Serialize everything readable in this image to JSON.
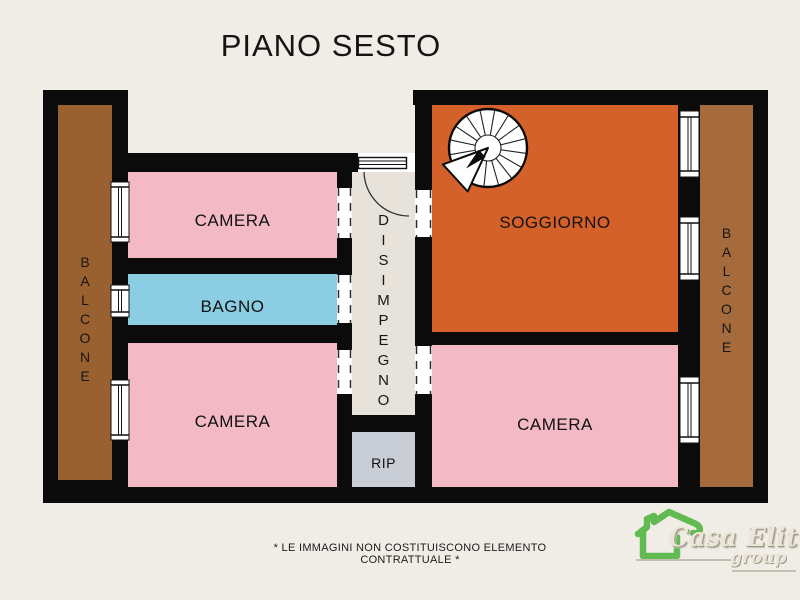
{
  "title": "PIANO SESTO",
  "disclaimer": "* LE IMMAGINI NON COSTITUISCONO ELEMENTO CONTRATTUALE *",
  "rooms": {
    "camera_top_left": {
      "label": "CAMERA",
      "color": "#f3b9c5"
    },
    "bagno": {
      "label": "BAGNO",
      "color": "#8bcde3"
    },
    "camera_bottom_left": {
      "label": "CAMERA",
      "color": "#f3b9c5"
    },
    "soggiorno": {
      "label": "SOGGIORNO",
      "color": "#d4612a"
    },
    "camera_bottom_right": {
      "label": "CAMERA",
      "color": "#f3b9c5"
    },
    "rip": {
      "label": "RIP",
      "color": "#c9cdd5"
    },
    "disimpegno": {
      "label": "DISIMPEGNO",
      "label_vertical": "D\nI\nS\nI\nM\nP\nE\nG\nN\nO",
      "color": "#e8e3da"
    },
    "balcone_left": {
      "label": "BALCONE",
      "label_vertical": "B\nA\nL\nC\nO\nN\nE",
      "color": "#9a6130"
    },
    "balcone_right": {
      "label": "BALCONE",
      "label_vertical": "B\nA\nL\nC\nO\nN\nE",
      "color": "#a56b3c"
    }
  },
  "features": {
    "spiral_staircase": "spiral staircase in soggiorno",
    "entrance_door": "entrance door at top of disimpegno",
    "window_count": 6,
    "door_opening_count": 5
  },
  "logo": {
    "brand": "Casa Elite",
    "sub": "group",
    "house_color": "#62bb52"
  },
  "colors": {
    "background": "#f0ede7",
    "walls": "#0b0b0b",
    "openings": "#ffffff",
    "title_text": "#141414",
    "label_text": "#121212"
  }
}
